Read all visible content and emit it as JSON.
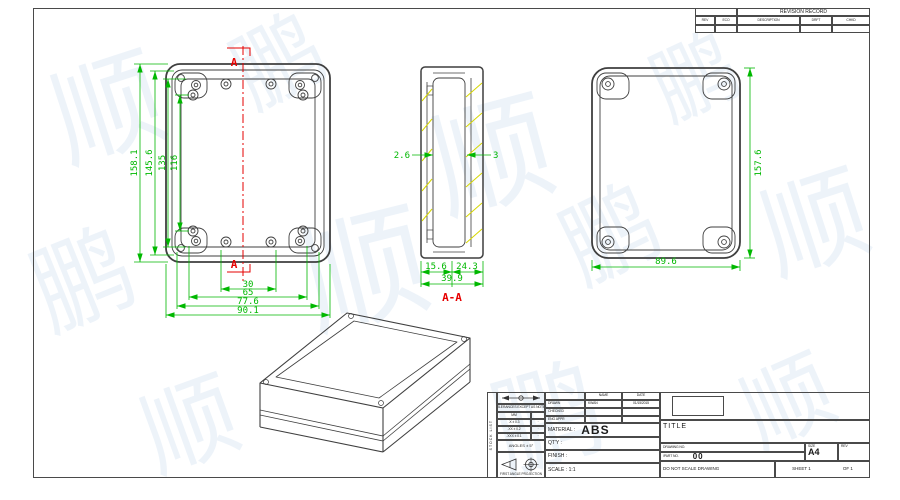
{
  "watermark": {
    "char_a": "顺",
    "char_b": "鹏"
  },
  "revision_table": {
    "title": "REVISION RECORD",
    "col_rev": "REV",
    "col_eco": "ECO",
    "col_desc": "DESCRIPTION",
    "col_drft": "DRFT",
    "col_chkd": "CHKD"
  },
  "front_view": {
    "dims_left": [
      "158.1",
      "145.6",
      "135",
      "116"
    ],
    "dims_bottom": [
      "30",
      "65",
      "77.6",
      "90.1"
    ],
    "section_marker": "A"
  },
  "section_view": {
    "label": "A-A",
    "dim_left_wall": "2.6",
    "dim_right_wall": "3",
    "dim_bottom_1": "15.6",
    "dim_bottom_2": "24.3",
    "dim_bottom_total": "39.9"
  },
  "side_view": {
    "dim_height": "157.6",
    "dim_width": "89.6"
  },
  "title_block": {
    "stock_list": "STOCK LIST",
    "tolerances": {
      "header": "TOLERANCES EXCEPT AS NOTED",
      "unit": "MM",
      "rows": [
        ".X ± 0.3",
        ".XX ± 0.2",
        ".XXX ± 0.1"
      ],
      "dot": "·",
      "angles": "ANGLES ± 5°",
      "projection": "FIRST ANGLE PROJECTION"
    },
    "info": {
      "name_header": "NAME",
      "date_header": "DATE",
      "drawn_label": "DRAWN",
      "drawn_name": "KWAN",
      "drawn_date": "01/15/2015",
      "checked_label": "CHECKED",
      "eng_appr_label": "ENG APPR",
      "material_label": "MATERIAL :",
      "material_value": "ABS",
      "qty_label": "QT'Y :",
      "finish_label": "FINISH :",
      "scale_label": "SCALE : 1:1"
    },
    "title_area": {
      "title_label": "TITLE",
      "drawing_no_label": "DRAWING NO.",
      "part_no_label": "/PART  NO.",
      "part_no_value": "00",
      "size_label": "SIZE",
      "size_value": "A4",
      "rev_label": "REV",
      "do_not_scale": "DO NOT SCALE DRAWING",
      "sheet_label": "SHEET 1",
      "of_label": "OF 1"
    }
  }
}
